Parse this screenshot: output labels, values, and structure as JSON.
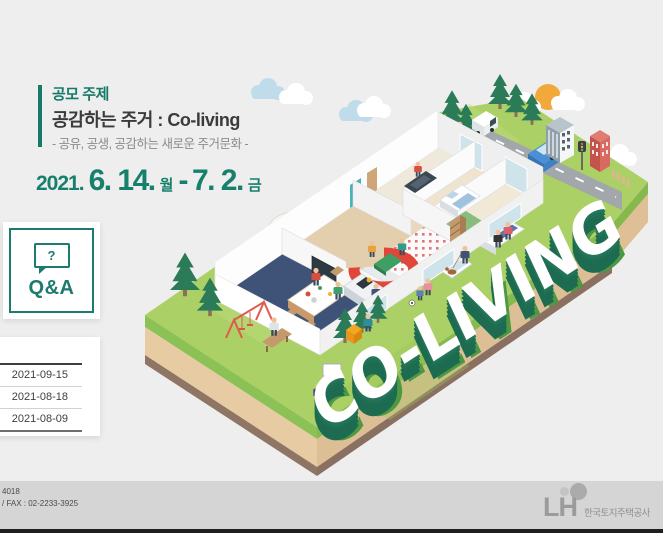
{
  "theme_colors": {
    "teal": "#177a68",
    "letters_green": "#1f6f53",
    "lawn_green": "#abd065",
    "footer_gray": "#d5d5d6"
  },
  "header": {
    "label": "공모 주제",
    "title": "공감하는 주거 : Co-living",
    "subtitle": "- 공유, 공생, 공감하는 새로운 주거문화 -"
  },
  "period": {
    "year": "2021.",
    "start": "6. 14.",
    "start_day": "월",
    "dash": "-",
    "end": "7. 2.",
    "end_day": "금"
  },
  "qna": {
    "label": "Q&A",
    "icon_mark": "?"
  },
  "notices": {
    "items": [
      "2021-09-15",
      "2021-08-18",
      "2021-08-09"
    ]
  },
  "illustration": {
    "word": "CO-LIVING"
  },
  "footer": {
    "phone_fragment": "4018",
    "fax_line": "/ FAX : 02-2233-3925",
    "logo_text": "LH",
    "company": "한국토지주택공사"
  }
}
